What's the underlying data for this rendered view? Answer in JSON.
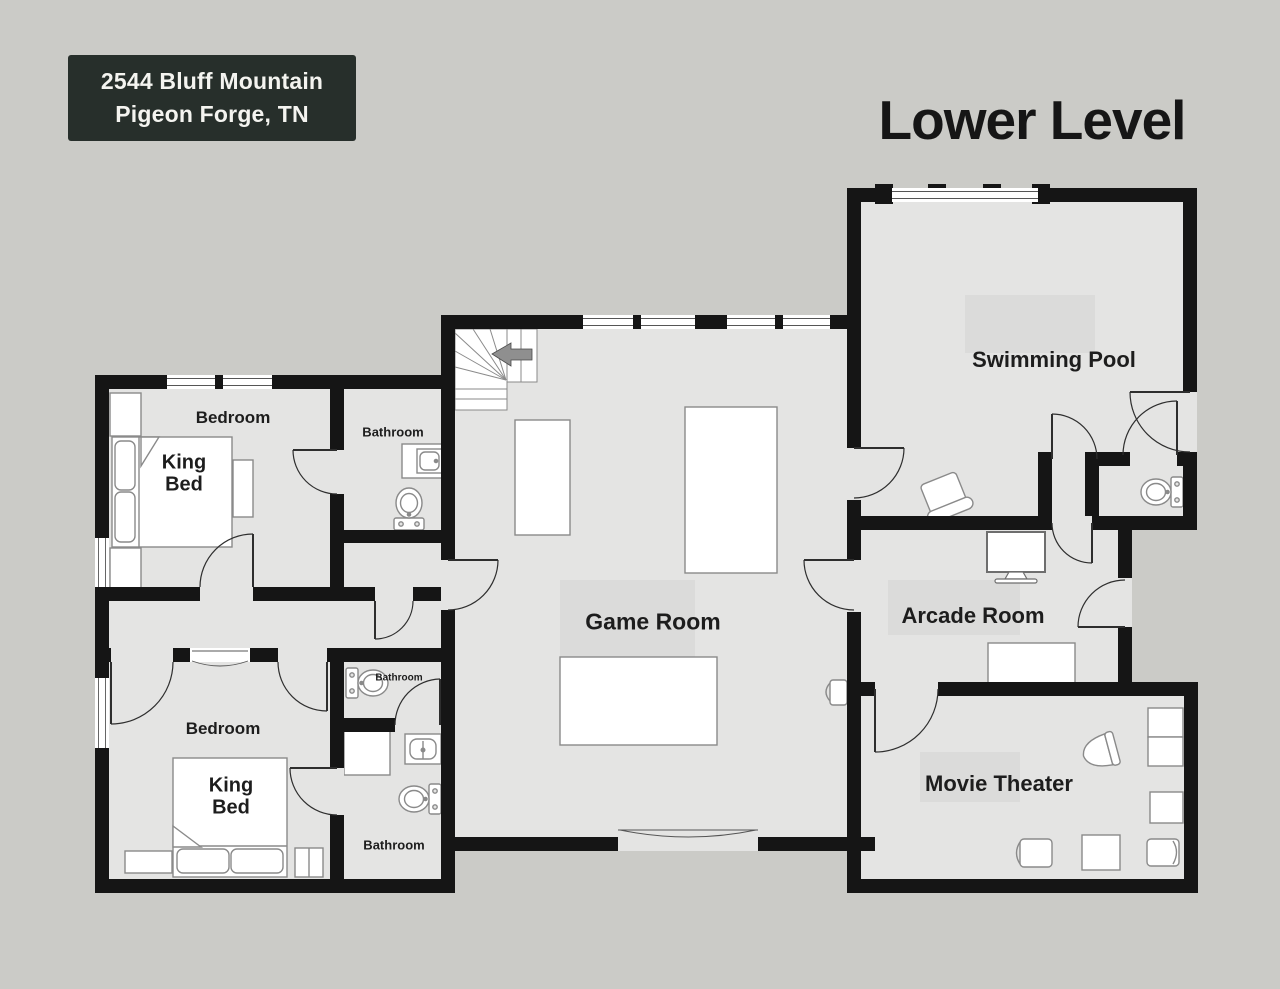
{
  "page": {
    "background_color": "#cbcbc7",
    "level_title": "Lower Level"
  },
  "address_badge": {
    "line1": "2544 Bluff Mountain",
    "line2": "Pigeon Forge, TN",
    "bg_color": "#272f2b",
    "text_color": "#f4f4f0"
  },
  "floorplan": {
    "wall_color": "#151515",
    "floor_color": "#e4e4e3",
    "furniture_fill": "#ffffff",
    "furniture_stroke": "#8a8a8a",
    "door_stroke": "#2e2e2e",
    "stairs_arrow_color": "#8f8f8f",
    "labels": {
      "bedroom_1": "Bedroom",
      "bedroom_2": "Bedroom",
      "king_bed_1": {
        "line1": "King",
        "line2": "Bed"
      },
      "king_bed_2": {
        "line1": "King",
        "line2": "Bed"
      },
      "bathroom_1": "Bathroom",
      "bathroom_2": "Bathroom",
      "bathroom_3": "Bathroom",
      "game_room": "Game Room",
      "swimming_pool": "Swimming Pool",
      "arcade_room": "Arcade Room",
      "movie_theater": "Movie Theater"
    },
    "icons": [
      "stairs-icon",
      "stairs-direction-arrow-icon",
      "toilet-icon",
      "sink-icon",
      "vanity-icon",
      "shower-icon",
      "king-bed-icon",
      "pillow-icon",
      "nightstand-icon",
      "bench-icon",
      "dresser-icon",
      "closet-unit-icon",
      "game-table-icon",
      "pool-table-icon",
      "wall-chair-icon",
      "pool-chair-icon",
      "tv-icon",
      "arcade-table-icon",
      "sofa-icon",
      "armchair-icon",
      "recliner-icon",
      "door-swing-icon",
      "double-door-icon",
      "patio-door-icon",
      "window-icon"
    ]
  }
}
